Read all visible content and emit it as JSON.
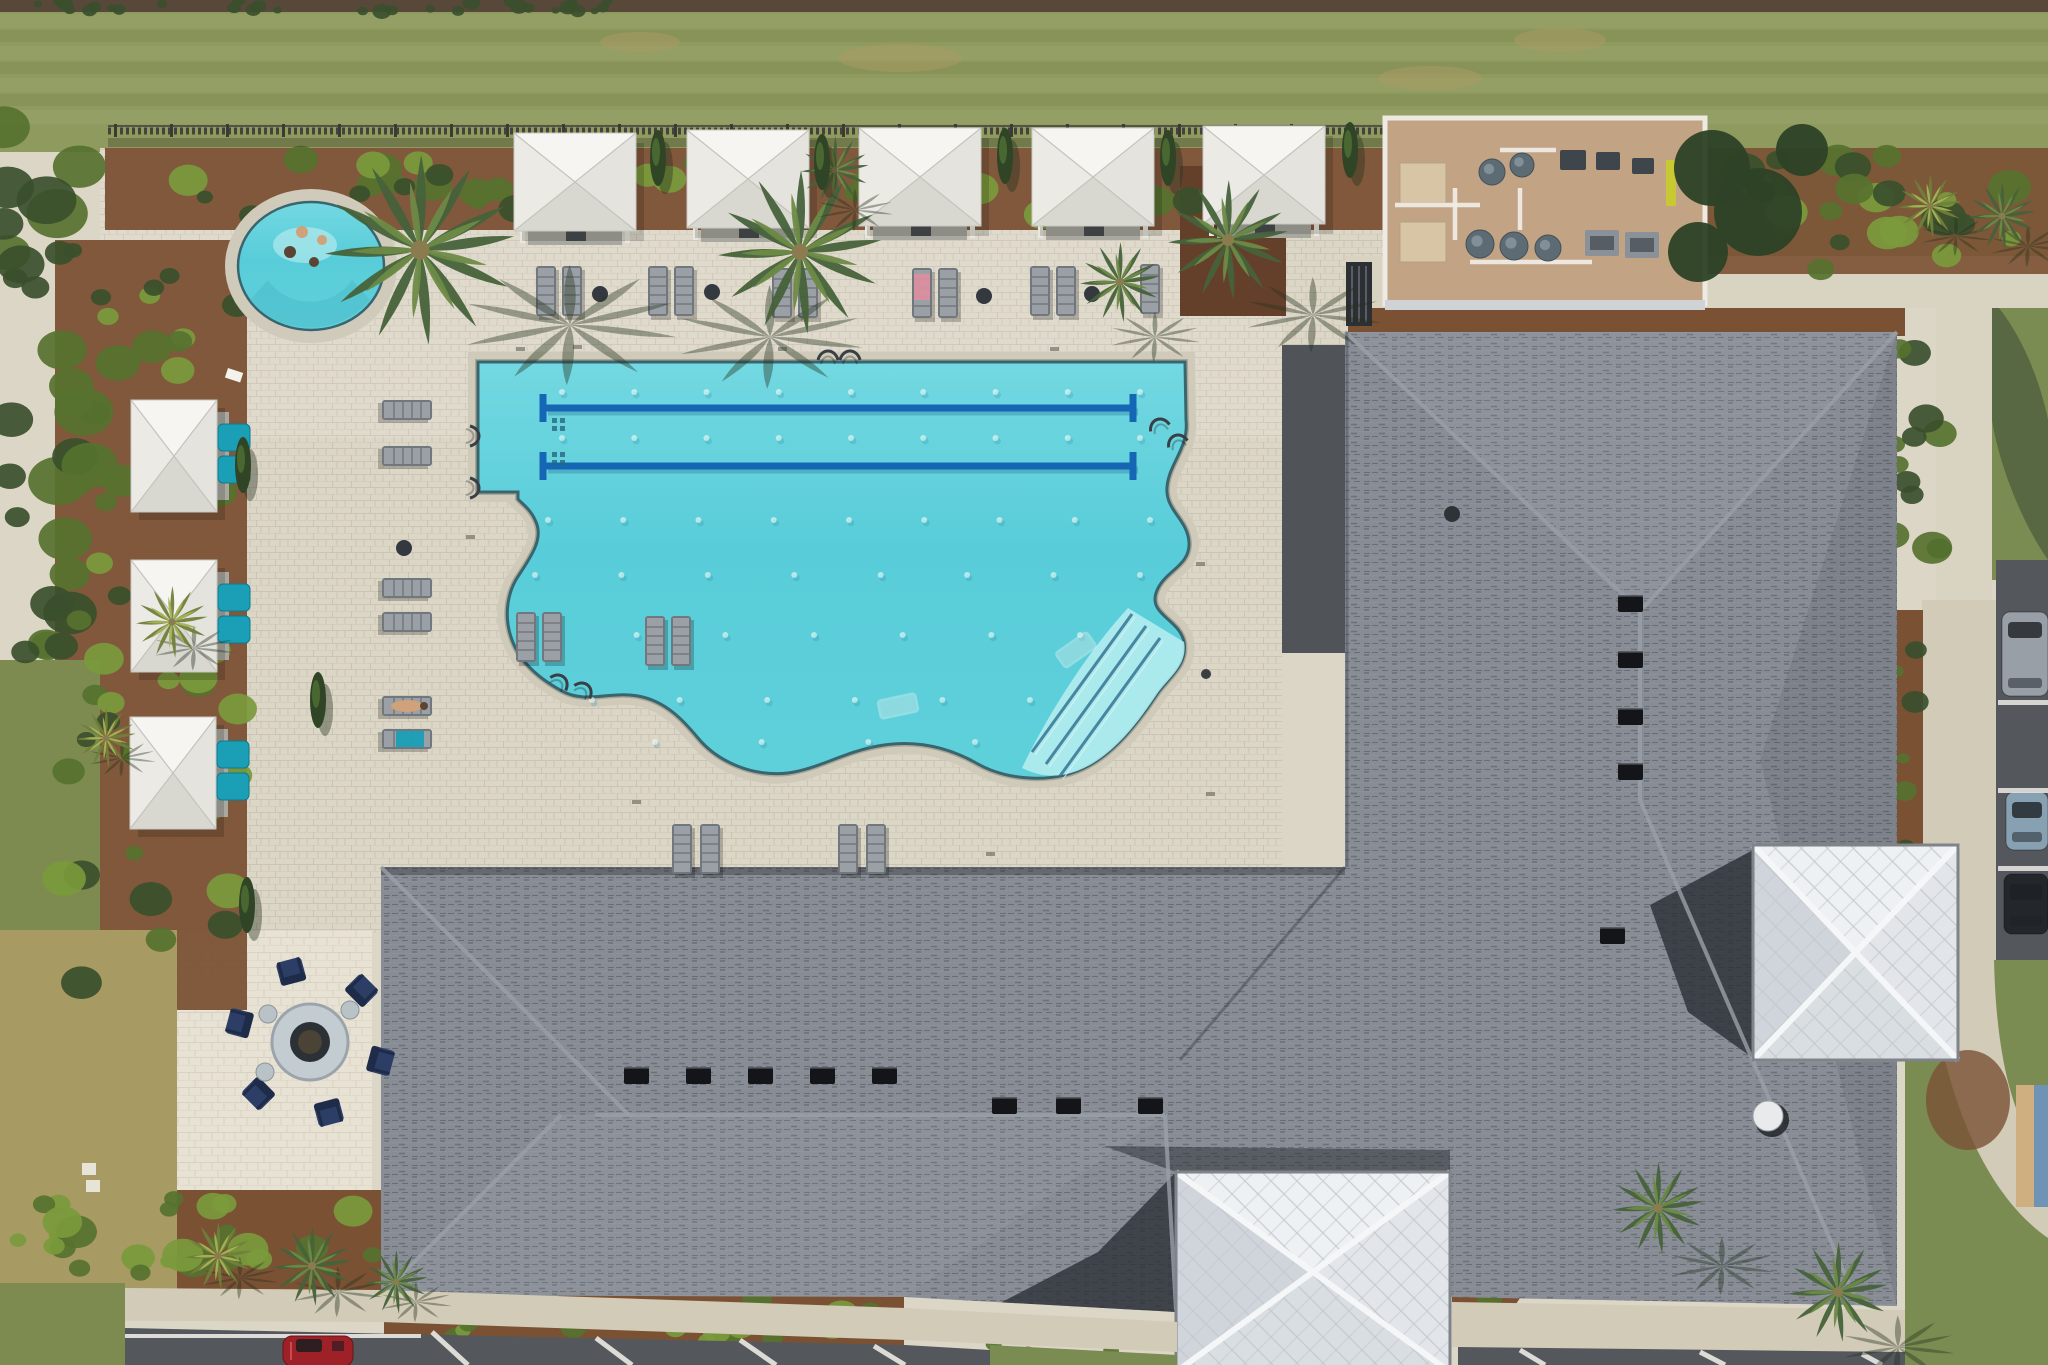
{
  "meta": {
    "kind": "aerial-drone-photograph",
    "subject": "Community amenity center: free-form lap pool, spa, cabanas, fire pit patio, pool equipment yard and large gray-shingled clubhouse roof with white metal cupolas, bordered by lawn, landscaping and parking"
  },
  "palette": {
    "deck": "#dcd6c7",
    "deckLine": "#b3ab96",
    "patio": "#e8e2d4",
    "walk": "#d2cbb8",
    "walk2": "#d9d3c2",
    "grass1": "#8f9a5e",
    "grass2": "#7d8b51",
    "grassPatch": "#a89a63",
    "grassBR": "#7a8c52",
    "dirt": "#57483a",
    "hedge": "#3a4f2c",
    "shrub": "#56722f",
    "shrubLight": "#7a9a3c",
    "mulch": "#7b5134",
    "mulchDark": "#64402a",
    "water": "#58cdd9",
    "waterLight": "#73d8e1",
    "waterEntry": "#b3ecee",
    "waterLine": "#39656f",
    "lane": "#1566b4",
    "laneShadow": "#2e7ca0",
    "coping": "#cfcaba",
    "copingDark": "#8d8878",
    "roof": "#878c95",
    "roofWing": "#8e939c",
    "roofShadow": "#2a2e34",
    "ridge": "#9ba0a8",
    "vent": "#141518",
    "cupola": "#e9ebed",
    "cupolaSeam": "#c3c8cd",
    "cupolaHip": "#f4f6f8",
    "cupolaEdge": "#7e848a",
    "pad": "#c2a383",
    "padBox": "#d8c5a6",
    "cyl": "#5c6b74",
    "pipe": "#efece4",
    "heater": "#8a9198",
    "sign": "#c8c832",
    "canopy": "#f3f2ee",
    "canopyTop": "#f6f5f1",
    "canopyL": "#ebeae5",
    "canopyR": "#e4e3dd",
    "canopyB": "#d8d7d0",
    "canopyLine": "#c4c3bd",
    "interior": "#a9a8a0",
    "teal": "#1a9fb7",
    "navy": "#2c3e66",
    "navyDark": "#1f2c49",
    "lounger": "#9aa0a5",
    "loungerDark": "#70777d",
    "tableDark": "#34393f",
    "tableLight": "#b9c2c6",
    "asphalt": "#54585c",
    "stripe": "#eceae4",
    "carRed": "#9e2128",
    "sand": "#cfae7f",
    "blueEdge": "#6f93b5",
    "skin": "#cfa27c",
    "towelPink": "#d98f9f",
    "towelTeal": "#1a9fb7",
    "shadowGreen": "#25321f"
  },
  "lawn": {
    "stripe_ys": [
      14,
      46,
      78,
      110
    ],
    "dark_ys": [
      30,
      62,
      94
    ],
    "dirt_patches": [
      [
        900,
        58,
        62,
        14
      ],
      [
        1430,
        78,
        52,
        12
      ],
      [
        640,
        42,
        40,
        10
      ],
      [
        1560,
        40,
        46,
        12
      ]
    ]
  },
  "fence": {
    "y": 130,
    "x0": 108,
    "x1": 1420,
    "post_step": 56
  },
  "pool": {
    "outline": "M478,362 L1185,362 L1186,420 C1189,448 1169,463 1167,487 C1165,511 1188,519 1189,543 C1190,567 1163,571 1156,593 C1149,615 1180,620 1184,642 C1188,665 1169,677 1157,694 C1141,718 1118,750 1088,766 C1056,784 1008,781 978,764 C950,748 916,739 878,746 C844,752 818,769 788,773 C753,777 718,762 698,738 C684,721 666,701 638,696 C608,691 586,704 562,691 C536,677 518,659 511,637 C504,616 507,592 519,575 C533,554 543,538 536,522 C531,509 521,503 518,499 L518,492 L478,492 Z",
    "entry_wedge": "M1022,768 C1040,730 1080,660 1128,608 L1184,642 C1188,665 1169,677 1157,694 C1141,718 1118,750 1088,766 C1062,780 1040,777 1022,768 Z",
    "lane_lines": {
      "ys": [
        408,
        466
      ],
      "x0": 543,
      "x1": 1133,
      "width": 7,
      "t_half": 14
    },
    "jet_rows": [
      {
        "y": 392,
        "x0": 562,
        "x1": 1140,
        "n": 9
      },
      {
        "y": 438,
        "x0": 562,
        "x1": 1140,
        "n": 9
      },
      {
        "y": 520,
        "x0": 548,
        "x1": 1150,
        "n": 9
      },
      {
        "y": 575,
        "x0": 535,
        "x1": 1140,
        "n": 8
      },
      {
        "y": 635,
        "x0": 548,
        "x1": 1080,
        "n": 7
      },
      {
        "y": 700,
        "x0": 592,
        "x1": 1030,
        "n": 6
      },
      {
        "y": 742,
        "x0": 655,
        "x1": 975,
        "n": 4
      }
    ],
    "entry_rails": [
      [
        1132,
        614,
        1032,
        752
      ],
      [
        1146,
        626,
        1046,
        764
      ],
      [
        1160,
        638,
        1060,
        776
      ]
    ],
    "handrails": [
      [
        470,
        436,
        90
      ],
      [
        470,
        488,
        90
      ],
      [
        828,
        360,
        0
      ],
      [
        850,
        360,
        0
      ],
      [
        1160,
        428,
        -20
      ],
      [
        1178,
        444,
        -20
      ],
      [
        558,
        684,
        40
      ],
      [
        582,
        692,
        40
      ]
    ],
    "water_loungers": [
      [
        1076,
        650,
        -35
      ],
      [
        898,
        706,
        -12
      ]
    ],
    "drain_pads": [
      [
        552,
        418
      ],
      [
        552,
        452
      ]
    ],
    "depth_markers": [
      [
        516,
        347
      ],
      [
        778,
        347
      ],
      [
        1050,
        347
      ],
      [
        1196,
        562
      ],
      [
        1206,
        792
      ],
      [
        632,
        800
      ],
      [
        986,
        852
      ],
      [
        466,
        535
      ],
      [
        573,
        345
      ]
    ]
  },
  "spa": {
    "cx": 311,
    "cy": 266,
    "rx": 73,
    "ry": 64,
    "people": [
      [
        302,
        232
      ],
      [
        322,
        240
      ],
      [
        290,
        252
      ],
      [
        314,
        262
      ]
    ]
  },
  "cabanas_top": [
    [
      514,
      133
    ],
    [
      687,
      130
    ],
    [
      859,
      128
    ],
    [
      1032,
      128
    ],
    [
      1203,
      126
    ]
  ],
  "cabanas_left": [
    [
      131,
      400
    ],
    [
      131,
      560
    ],
    [
      130,
      717
    ]
  ],
  "teal_chairs": [
    [
      218,
      424
    ],
    [
      218,
      456
    ],
    [
      218,
      584
    ],
    [
      218,
      616
    ],
    [
      217,
      741
    ],
    [
      217,
      773
    ]
  ],
  "loungers": [
    [
      536,
      266,
      0,
      ""
    ],
    [
      562,
      266,
      0,
      ""
    ],
    [
      648,
      266,
      0,
      ""
    ],
    [
      674,
      266,
      0,
      ""
    ],
    [
      772,
      268,
      0,
      ""
    ],
    [
      798,
      268,
      0,
      ""
    ],
    [
      912,
      268,
      0,
      "pink"
    ],
    [
      938,
      268,
      0,
      ""
    ],
    [
      1030,
      266,
      0,
      ""
    ],
    [
      1056,
      266,
      0,
      ""
    ],
    [
      1140,
      264,
      0,
      ""
    ],
    [
      516,
      612,
      0,
      ""
    ],
    [
      542,
      612,
      0,
      ""
    ],
    [
      645,
      616,
      0,
      ""
    ],
    [
      671,
      616,
      0,
      ""
    ],
    [
      672,
      824,
      0,
      ""
    ],
    [
      700,
      824,
      0,
      ""
    ],
    [
      838,
      824,
      0,
      ""
    ],
    [
      866,
      824,
      0,
      ""
    ],
    [
      432,
      400,
      90,
      ""
    ],
    [
      432,
      446,
      90,
      ""
    ],
    [
      432,
      578,
      90,
      ""
    ],
    [
      432,
      612,
      90,
      ""
    ],
    [
      432,
      696,
      90,
      "person"
    ],
    [
      432,
      729,
      90,
      "tealTowel"
    ]
  ],
  "deck_tables": [
    [
      600,
      294
    ],
    [
      712,
      292
    ],
    [
      984,
      296
    ],
    [
      1092,
      294
    ],
    [
      404,
      548
    ]
  ],
  "fire_pit": {
    "cx": 310,
    "cy": 1042,
    "chair_radius": 74,
    "chair_angles": [
      15,
      75,
      135,
      195,
      255,
      315
    ],
    "side_tables": [
      [
        268,
        1014
      ],
      [
        350,
        1010
      ],
      [
        265,
        1072
      ]
    ]
  },
  "building": {
    "outline": "M381,867 L1345,867 L1345,332 L1897,332 L1897,1306 L1452,1297 L1176,1312 L905,1297 L381,1295 Z",
    "hips": [
      [
        1345,
        332,
        1637,
        608
      ],
      [
        1897,
        332,
        1643,
        608
      ],
      [
        1640,
        605,
        1640,
        800
      ],
      [
        1640,
        800,
        1858,
        1304
      ],
      [
        381,
        867,
        629,
        1115
      ],
      [
        381,
        1295,
        561,
        1115
      ],
      [
        595,
        1115,
        1165,
        1115
      ],
      [
        1165,
        1115,
        1176,
        1310
      ]
    ],
    "valleys": [
      [
        1345,
        867,
        1180,
        1060
      ]
    ],
    "vents": [
      [
        1630,
        604
      ],
      [
        1630,
        660
      ],
      [
        1630,
        717
      ],
      [
        1630,
        772
      ],
      [
        1612,
        936
      ],
      [
        636,
        1076
      ],
      [
        698,
        1076
      ],
      [
        760,
        1076
      ],
      [
        822,
        1076
      ],
      [
        884,
        1076
      ],
      [
        1004,
        1106
      ],
      [
        1068,
        1106
      ],
      [
        1150,
        1106
      ]
    ],
    "fan_vent": [
      1768,
      1116
    ],
    "cupolas": [
      {
        "x": 1753,
        "y": 845,
        "w": 205,
        "h": 215
      },
      {
        "x": 1176,
        "y": 1172,
        "w": 274,
        "h": 200
      }
    ]
  },
  "equipment": {
    "pad": [
      1385,
      118,
      320,
      186
    ],
    "tan_boxes": [
      [
        1400,
        163,
        46,
        40
      ],
      [
        1400,
        222,
        46,
        40
      ]
    ],
    "cylinders": [
      [
        1492,
        172,
        13
      ],
      [
        1522,
        165,
        12
      ],
      [
        1480,
        244,
        14
      ],
      [
        1514,
        246,
        14
      ],
      [
        1548,
        248,
        13
      ]
    ],
    "pumps": [
      [
        1560,
        150,
        26,
        20
      ],
      [
        1596,
        152,
        24,
        18
      ],
      [
        1632,
        158,
        22,
        16
      ]
    ],
    "heaters": [
      [
        1585,
        230,
        34,
        26
      ],
      [
        1625,
        232,
        34,
        26
      ]
    ],
    "pipes": [
      "M1395,205 L1480,205",
      "M1455,188 L1455,240",
      "M1470,262 L1592,262",
      "M1500,150 L1556,150",
      "M1520,188 L1520,230"
    ],
    "sign": [
      1666,
      160,
      10,
      46
    ]
  },
  "equipment_trees": [
    [
      1712,
      168,
      38
    ],
    [
      1758,
      212,
      44
    ],
    [
      1698,
      252,
      30
    ],
    [
      1802,
      150,
      26
    ]
  ],
  "cypresses": [
    [
      658,
      158
    ],
    [
      1005,
      156
    ],
    [
      1168,
      158
    ],
    [
      1350,
      150
    ],
    [
      243,
      465
    ],
    [
      318,
      700
    ],
    [
      247,
      905
    ],
    [
      822,
      162
    ]
  ],
  "palms": [
    [
      420,
      250,
      95,
      "g",
      150,
      75
    ],
    [
      800,
      252,
      82,
      "g",
      -30,
      85
    ],
    [
      1228,
      240,
      60,
      "g",
      85,
      75
    ],
    [
      1120,
      282,
      40,
      "g",
      35,
      55
    ],
    [
      835,
      170,
      34,
      "g",
      20,
      40
    ],
    [
      172,
      622,
      36,
      "y",
      22,
      26
    ],
    [
      106,
      738,
      30,
      "y",
      16,
      20
    ],
    [
      218,
      1256,
      34,
      "y",
      22,
      22
    ],
    [
      312,
      1266,
      40,
      "g",
      26,
      26
    ],
    [
      396,
      1282,
      32,
      "g",
      20,
      20
    ],
    [
      1658,
      1208,
      46,
      "g",
      64,
      58
    ],
    [
      1838,
      1292,
      50,
      "g",
      60,
      55
    ],
    [
      1930,
      206,
      32,
      "y",
      26,
      30
    ],
    [
      2002,
      216,
      34,
      "g",
      26,
      30
    ]
  ],
  "bush_strips": [
    {
      "x": 112,
      "y": 158,
      "w": 1290,
      "h": 58,
      "n": 44,
      "r": 14,
      "fills": [
        "shrub",
        "shrubLight",
        "hedge"
      ]
    },
    {
      "x": 62,
      "y": 250,
      "w": 178,
      "h": 740,
      "n": 48,
      "r": 16,
      "fills": [
        "shrub",
        "hedge",
        "shrubLight"
      ]
    },
    {
      "x": 0,
      "y": 104,
      "w": 90,
      "h": 550,
      "n": 30,
      "r": 22,
      "fills": [
        "hedge",
        "shrub"
      ]
    },
    {
      "x": 6,
      "y": 1196,
      "w": 368,
      "h": 78,
      "n": 26,
      "r": 15,
      "fills": [
        "shrubLight",
        "shrub"
      ]
    },
    {
      "x": 388,
      "y": 1298,
      "w": 508,
      "h": 44,
      "n": 22,
      "r": 13,
      "fills": [
        "shrub",
        "shrubLight"
      ]
    },
    {
      "x": 1705,
      "y": 152,
      "w": 330,
      "h": 118,
      "n": 24,
      "r": 17,
      "fills": [
        "shrub",
        "hedge",
        "shrubLight"
      ]
    },
    {
      "x": 1893,
      "y": 338,
      "w": 50,
      "h": 260,
      "n": 12,
      "r": 15,
      "fills": [
        "hedge",
        "shrub"
      ]
    },
    {
      "x": 1895,
      "y": 640,
      "w": 26,
      "h": 300,
      "n": 9,
      "r": 10,
      "fills": [
        "shrub",
        "hedge"
      ]
    },
    {
      "x": 1452,
      "y": 1262,
      "w": 78,
      "h": 44,
      "n": 5,
      "r": 11,
      "fills": [
        "shrub"
      ]
    },
    {
      "x": 990,
      "y": 1344,
      "w": 183,
      "h": 18,
      "n": 5,
      "r": 9,
      "fills": [
        "shrub"
      ]
    },
    {
      "x": 0,
      "y": 0,
      "w": 640,
      "h": 12,
      "n": 30,
      "r": 7,
      "fills": [
        "hedge"
      ]
    }
  ],
  "cars_right": [
    {
      "x": 2002,
      "y": 612,
      "w": 46,
      "h": 84,
      "c": "#999fa6"
    },
    {
      "x": 2006,
      "y": 792,
      "w": 42,
      "h": 58,
      "c": "#87a0b2"
    },
    {
      "x": 2004,
      "y": 874,
      "w": 44,
      "h": 60,
      "c": "#23262b"
    }
  ],
  "stripes_right": [
    [
      1998,
      700
    ],
    [
      1998,
      788
    ],
    [
      1998,
      866
    ]
  ],
  "red_car": {
    "x": 283,
    "y": 1336
  },
  "stripes_bl": [
    [
      432,
      1332,
      468,
      1365
    ],
    [
      596,
      1338,
      632,
      1365
    ],
    [
      740,
      1340,
      776,
      1365
    ],
    [
      874,
      1346,
      905,
      1365
    ]
  ],
  "stripes_br": [
    [
      1520,
      1350,
      1545,
      1365
    ],
    [
      1700,
      1352,
      1725,
      1365
    ],
    [
      1862,
      1354,
      1882,
      1365
    ]
  ],
  "misc": {
    "white_papers": [
      [
        82,
        1163
      ],
      [
        86,
        1180
      ]
    ],
    "spa_towel": [
      228,
      368
    ],
    "trash_can": [
      1452,
      514
    ],
    "deck_dot": [
      1206,
      674
    ]
  }
}
